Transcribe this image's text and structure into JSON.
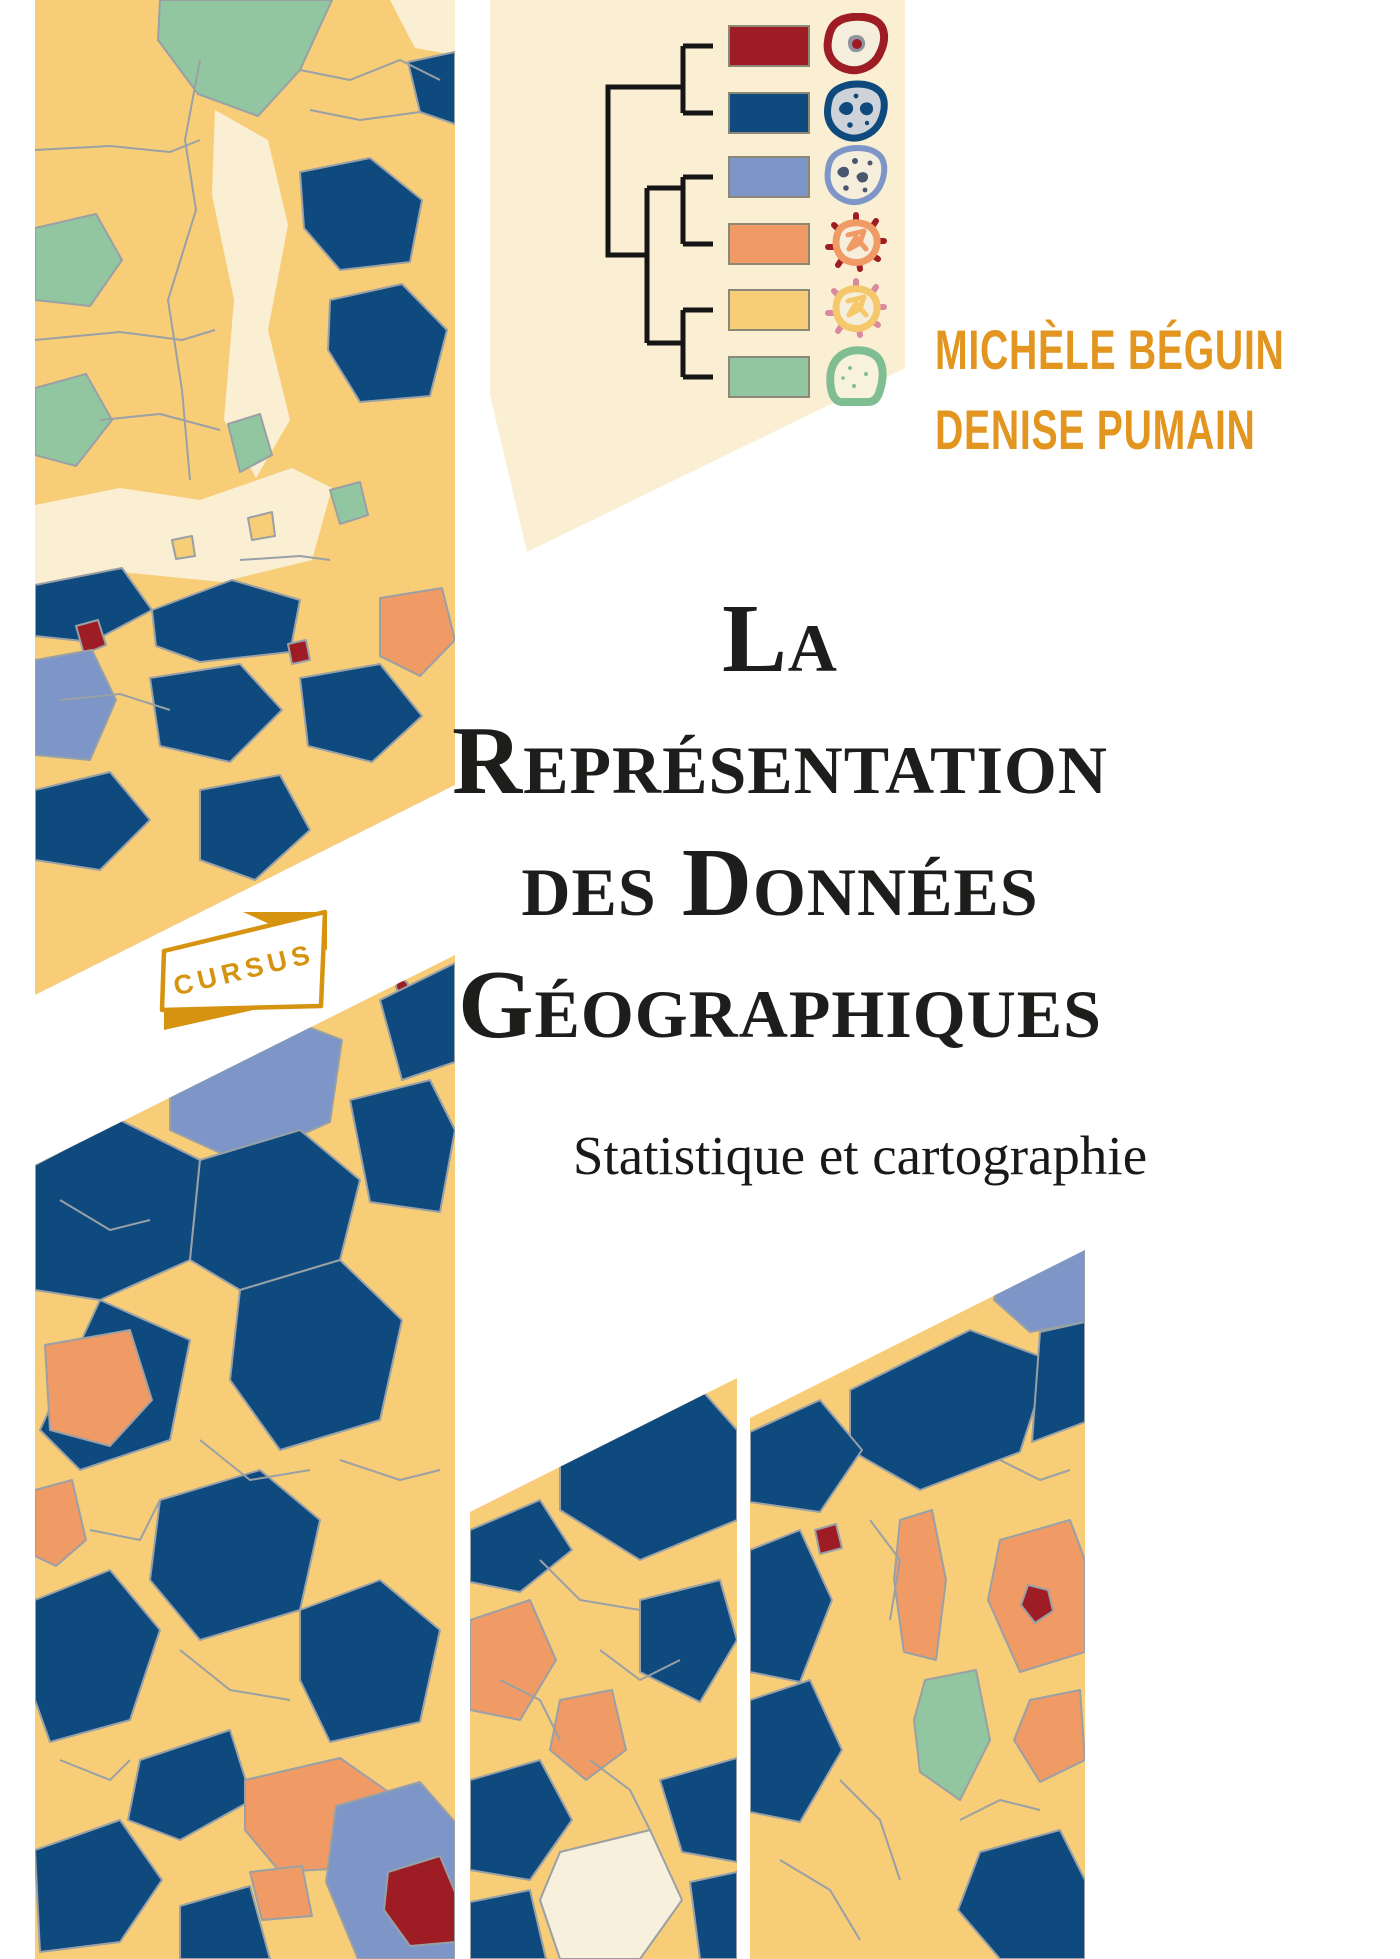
{
  "book_cover": {
    "authors": [
      "MICHÈLE BÉGUIN",
      "DENISE PUMAIN"
    ],
    "title_lines": [
      "La",
      "Représentation",
      "des Données",
      "Géographiques"
    ],
    "subtitle": "Statistique et cartographie",
    "collection": "CURSUS",
    "palette": {
      "cream_panel": "#FAEFD2",
      "map_yellow": "#F8CD78",
      "map_dark_blue": "#0E4A7E",
      "map_periwinkle": "#7D96C7",
      "map_salmon": "#F09A66",
      "map_dark_red": "#9E1C23",
      "map_green": "#92C6A0",
      "map_border_gray": "#99A0A6",
      "sea_cream": "#FAEFD2",
      "pale_land": "#F7F0DC",
      "gold": "#D6930F",
      "author_gold": "#E2951F",
      "title_ink": "#1D1D1B",
      "dendrogram_line": "#151515"
    },
    "legend": {
      "items": [
        {
          "class": "1",
          "color": "#9E1C23",
          "icon": "core-city-blob-icon"
        },
        {
          "class": "2",
          "color": "#0E4A7E",
          "icon": "dense-patches-blob-icon"
        },
        {
          "class": "3",
          "color": "#7D96C7",
          "icon": "scattered-spots-blob-icon"
        },
        {
          "class": "4",
          "color": "#F09A66",
          "icon": "radiating-core-blob-icon"
        },
        {
          "class": "5",
          "color": "#F8CD78",
          "icon": "radiating-light-blob-icon"
        },
        {
          "class": "6",
          "color": "#92C6A0",
          "icon": "sparse-blob-icon"
        }
      ]
    }
  }
}
